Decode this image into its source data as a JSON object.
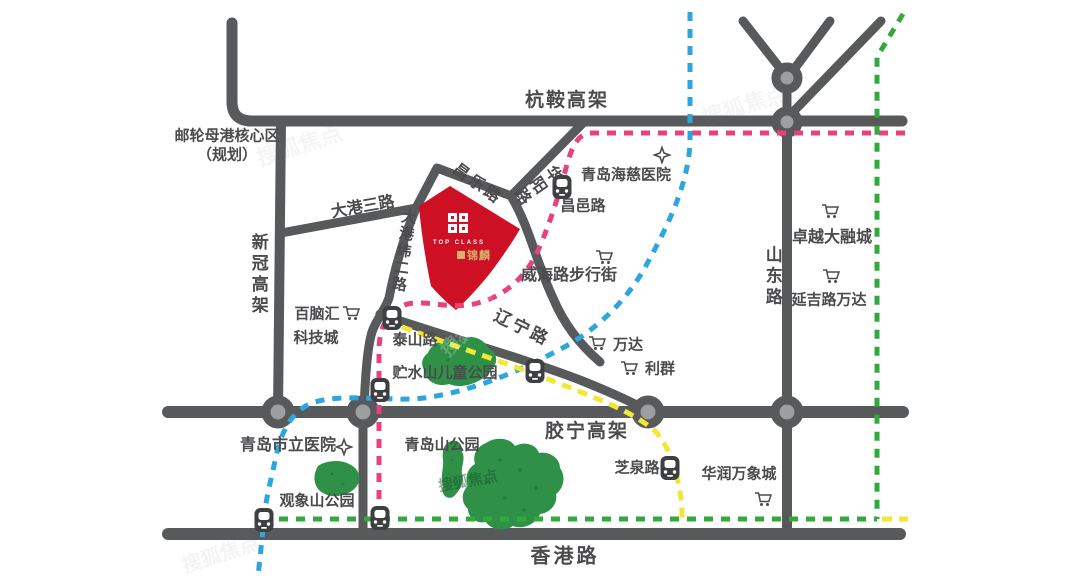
{
  "map": {
    "colors": {
      "road": "#58595b",
      "roundabout_fill": "#9d9ea0",
      "parcel_red": "#ce1024",
      "park_green": "#2f9148",
      "park_dot": "#1e6b33",
      "line_pink": "#e8417c",
      "line_blue": "#2ca6de",
      "line_green": "#33a93c",
      "line_yellow": "#f2e637",
      "station_icon": "#3e3f41",
      "label_text": "#4b4b4d"
    },
    "project": {
      "seal_caption": "TOP CLASS",
      "name_badge": "锦麟"
    },
    "roads": {
      "hangan": "杭鞍高架",
      "xinguan": "新冠高架",
      "dagang3": "大港三路",
      "dagangwei2": "大港纬二路",
      "changle": "昌乐路",
      "huayang": "华阳路",
      "liaoning": "辽宁路",
      "shandong": "山东路",
      "jiaoning": "胶宁高架",
      "xianggang": "香港路"
    },
    "places": {
      "cruise_line1": "邮轮母港核心区",
      "cruise_line2": "（规划）",
      "haici_hospital": "青岛海慈医院",
      "changyi_station": "昌邑路",
      "zhuoyue_mall": "卓越大融城",
      "yanji_wanda": "延吉路万达",
      "weihai_street": "威海路步行街",
      "wanda": "万达",
      "liqun": "利群",
      "bainaohui_line1": "百脑汇",
      "bainaohui_line2": "科技城",
      "taishan_station": "泰山路",
      "zhushuishan_park": "贮水山儿童公园",
      "shili_hospital": "青岛市立医院",
      "qingdaoshan_park": "青岛山公园",
      "guanxiangshan_park": "观象山公园",
      "zhiquan_station": "芝泉路",
      "mixc": "华润万象城"
    },
    "watermark": "搜狐焦点"
  }
}
